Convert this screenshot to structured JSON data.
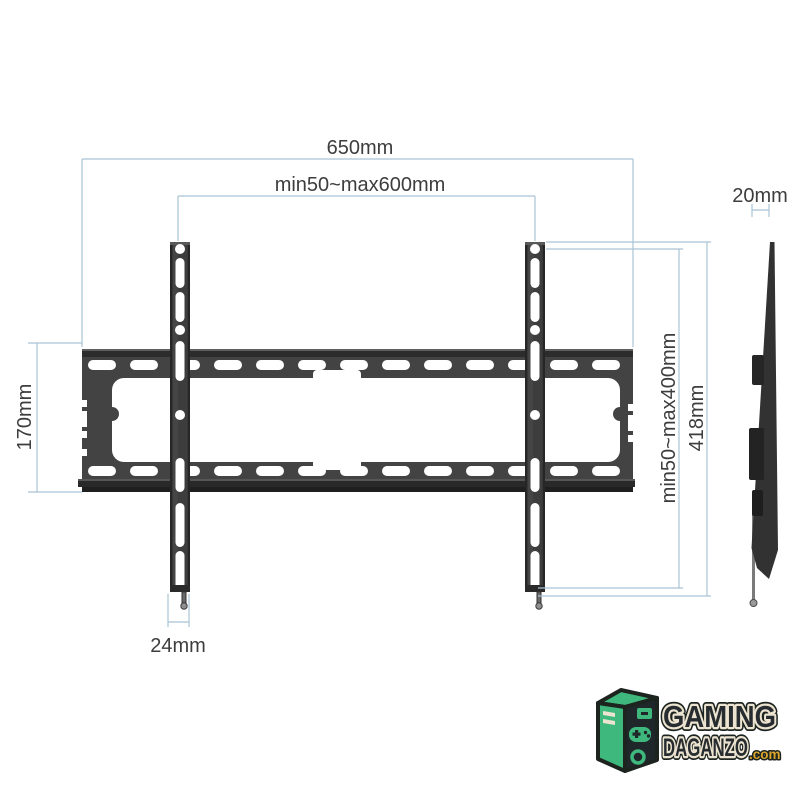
{
  "title": "TV wall mount bracket dimension diagram",
  "dimensions": {
    "total_width": "650mm",
    "horizontal_hole_pattern": "min50~max600mm",
    "profile_depth": "20mm",
    "plate_height": "170mm",
    "vertical_hole_pattern": "min50~max400mm",
    "bracket_height": "418mm",
    "rail_width": "24mm"
  },
  "logo": {
    "brand_line1": "GAMING",
    "brand_line2": "DAGANZO",
    "suffix": ".com"
  },
  "colors": {
    "dimension_line": "#a9c4d6",
    "dimension_text": "#3d3d3d",
    "metal_dark": "#2c2c2c",
    "metal_mid": "#434343",
    "logo_green": "#3eb87c",
    "logo_dark": "#1d2420",
    "logo_cream": "#ece4d0",
    "logo_gold": "#d9a42c"
  }
}
